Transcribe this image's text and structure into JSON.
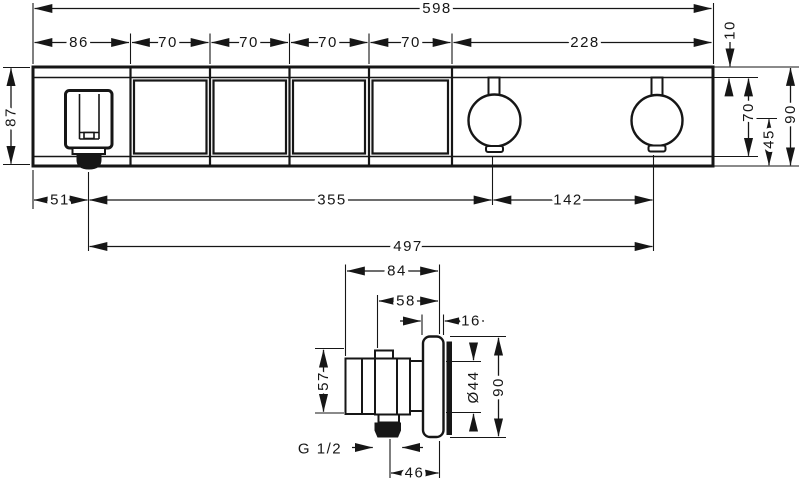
{
  "dims": {
    "top": {
      "overall": "598",
      "segments": [
        "86",
        "70",
        "70",
        "70",
        "70",
        "228"
      ],
      "top_band": "10",
      "plate_height_left": "87",
      "face_height": "70",
      "knob_center_to_bottom": "45",
      "plate_height_right": "90",
      "outlet_from_left": "51",
      "outlet_to_knob1": "355",
      "knob_spacing": "142",
      "outlet_to_knob2": "497"
    },
    "side": {
      "total_depth": "84",
      "body_depth": "58",
      "escutcheon_depth": "16",
      "body_height": "57",
      "inner_diameter": "Ø44",
      "escutcheon_height": "90",
      "thread_size": "G 1/2",
      "axis_to_face": "46"
    }
  }
}
